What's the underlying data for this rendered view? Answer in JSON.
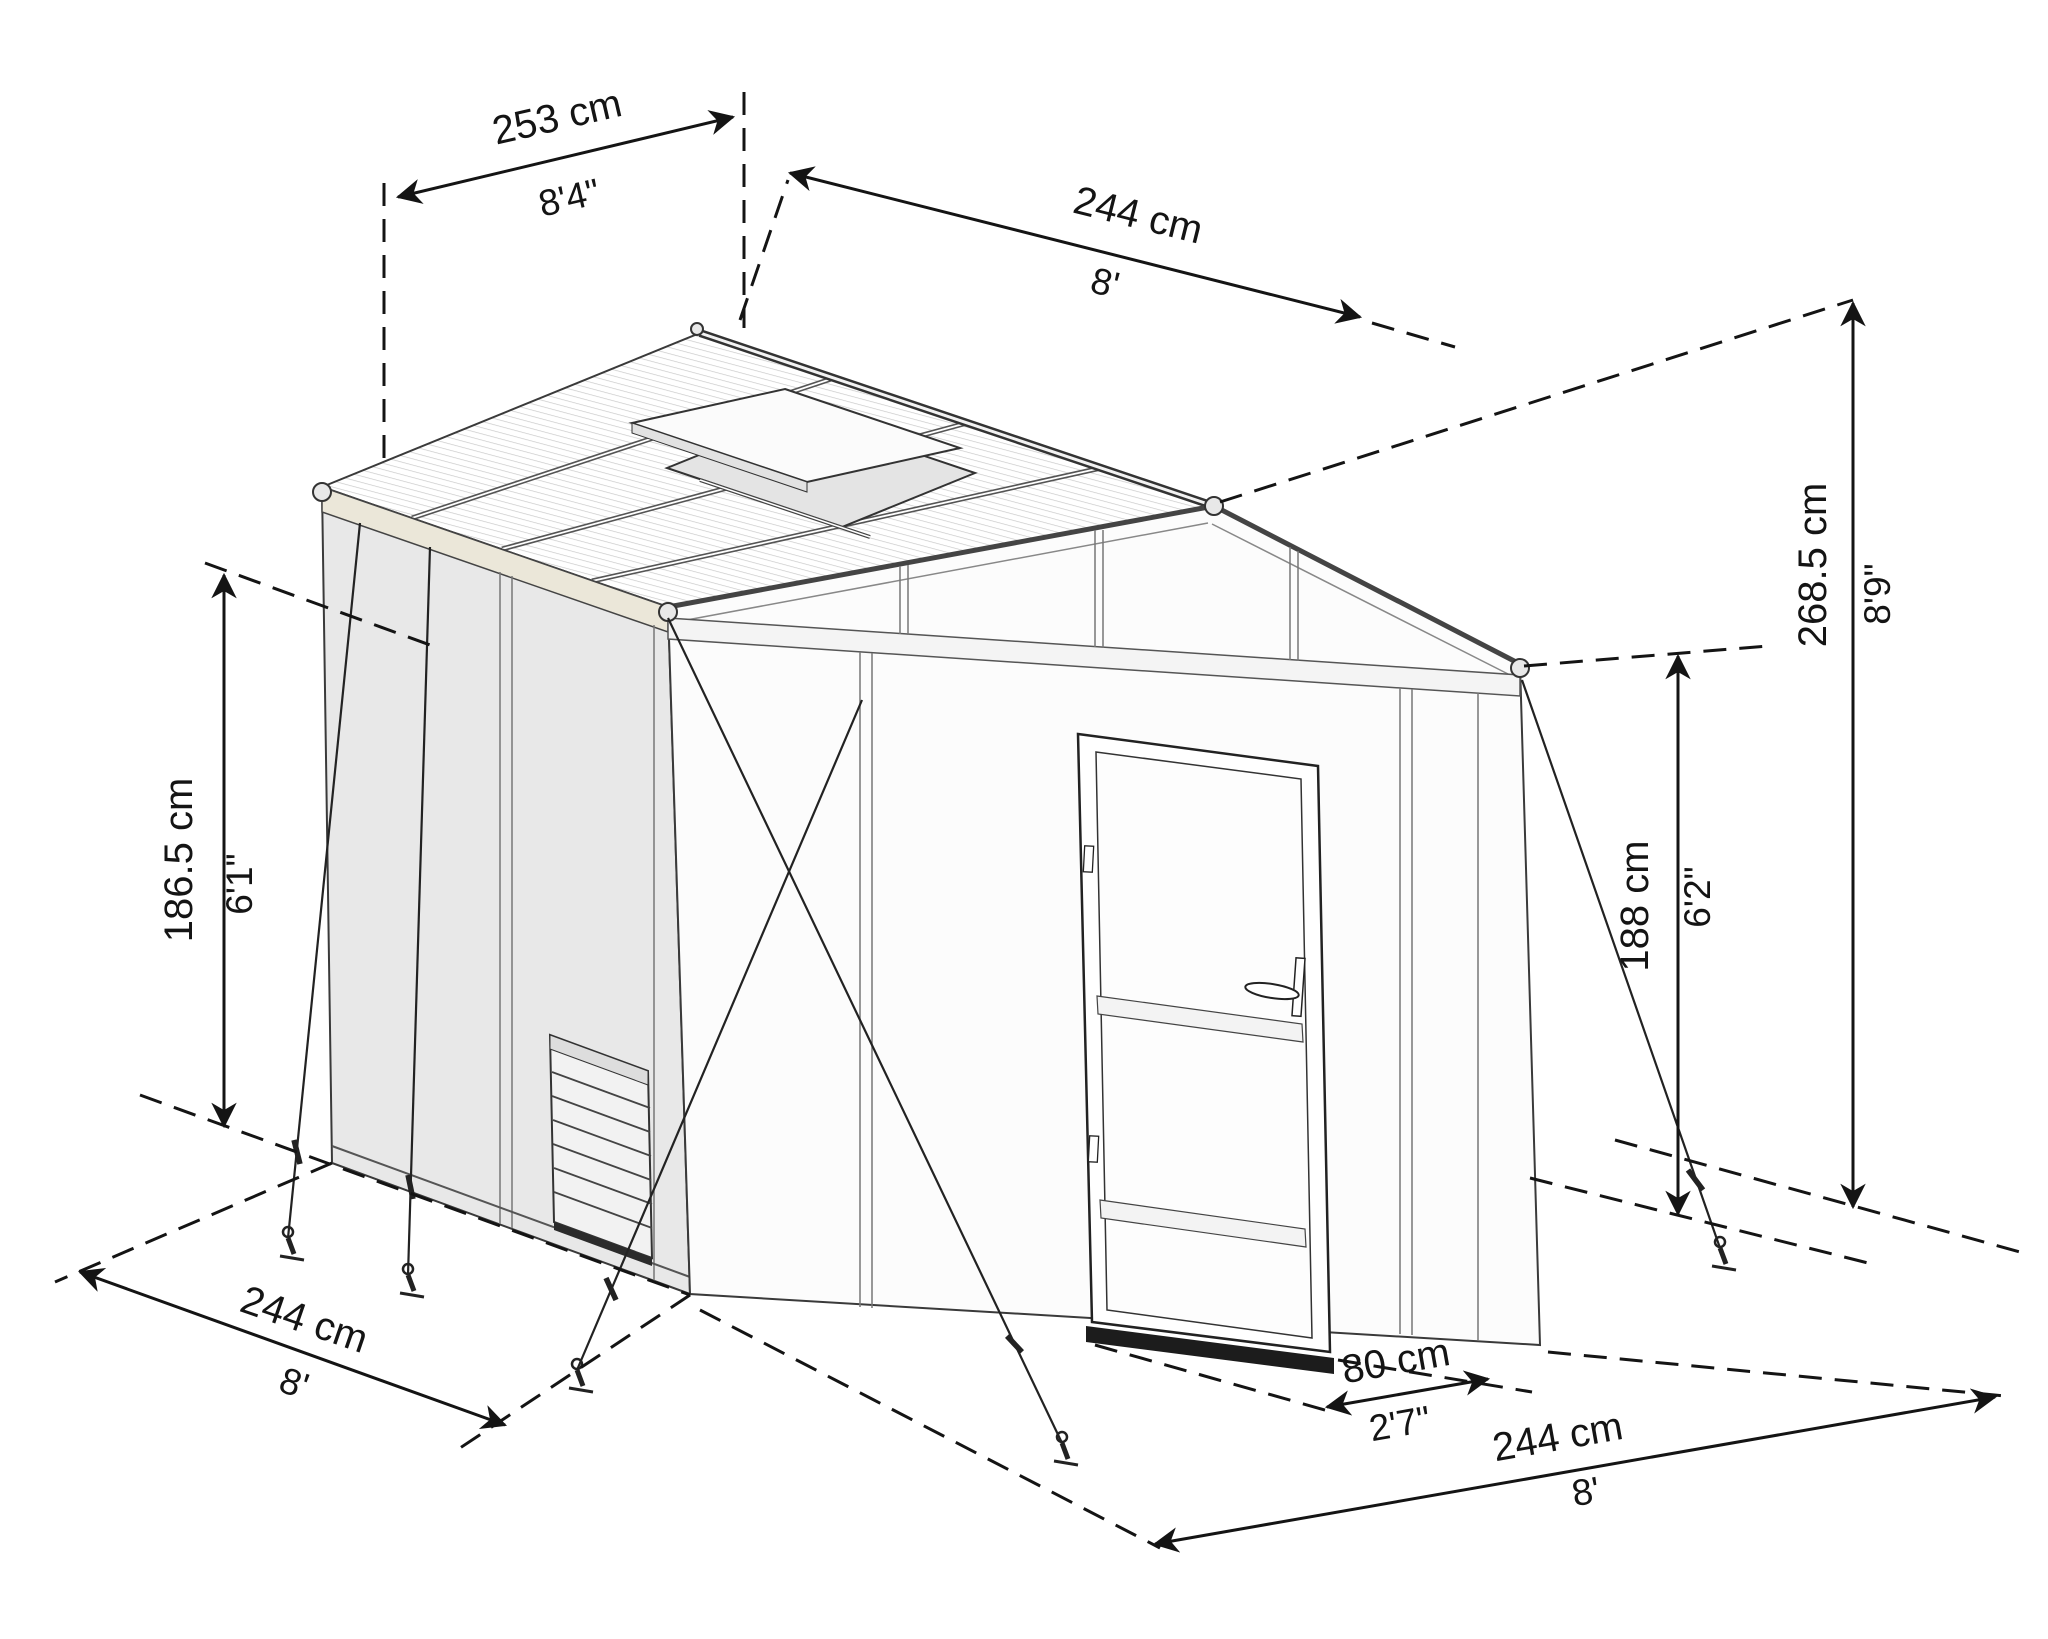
{
  "diagram": {
    "subject": "Greenhouse isometric dimension drawing",
    "background_color": "#ffffff",
    "line_color": "#141414",
    "wall_color": "#e8e8e8",
    "gutter_color": "#ebe7d9"
  },
  "dimensions": {
    "roof_panel_width": {
      "metric": "253 cm",
      "imperial": "8'4\""
    },
    "roof_length": {
      "metric": "244 cm",
      "imperial": "8'"
    },
    "side_wall_height": {
      "metric": "186.5 cm",
      "imperial": "6'1\""
    },
    "peak_height": {
      "metric": "268.5 cm",
      "imperial": "8'9\""
    },
    "door_height": {
      "metric": "188 cm",
      "imperial": "6'2\""
    },
    "base_depth": {
      "metric": "244 cm",
      "imperial": "8'"
    },
    "door_width": {
      "metric": "80 cm",
      "imperial": "2'7\""
    },
    "base_width": {
      "metric": "244 cm",
      "imperial": "8'"
    }
  }
}
